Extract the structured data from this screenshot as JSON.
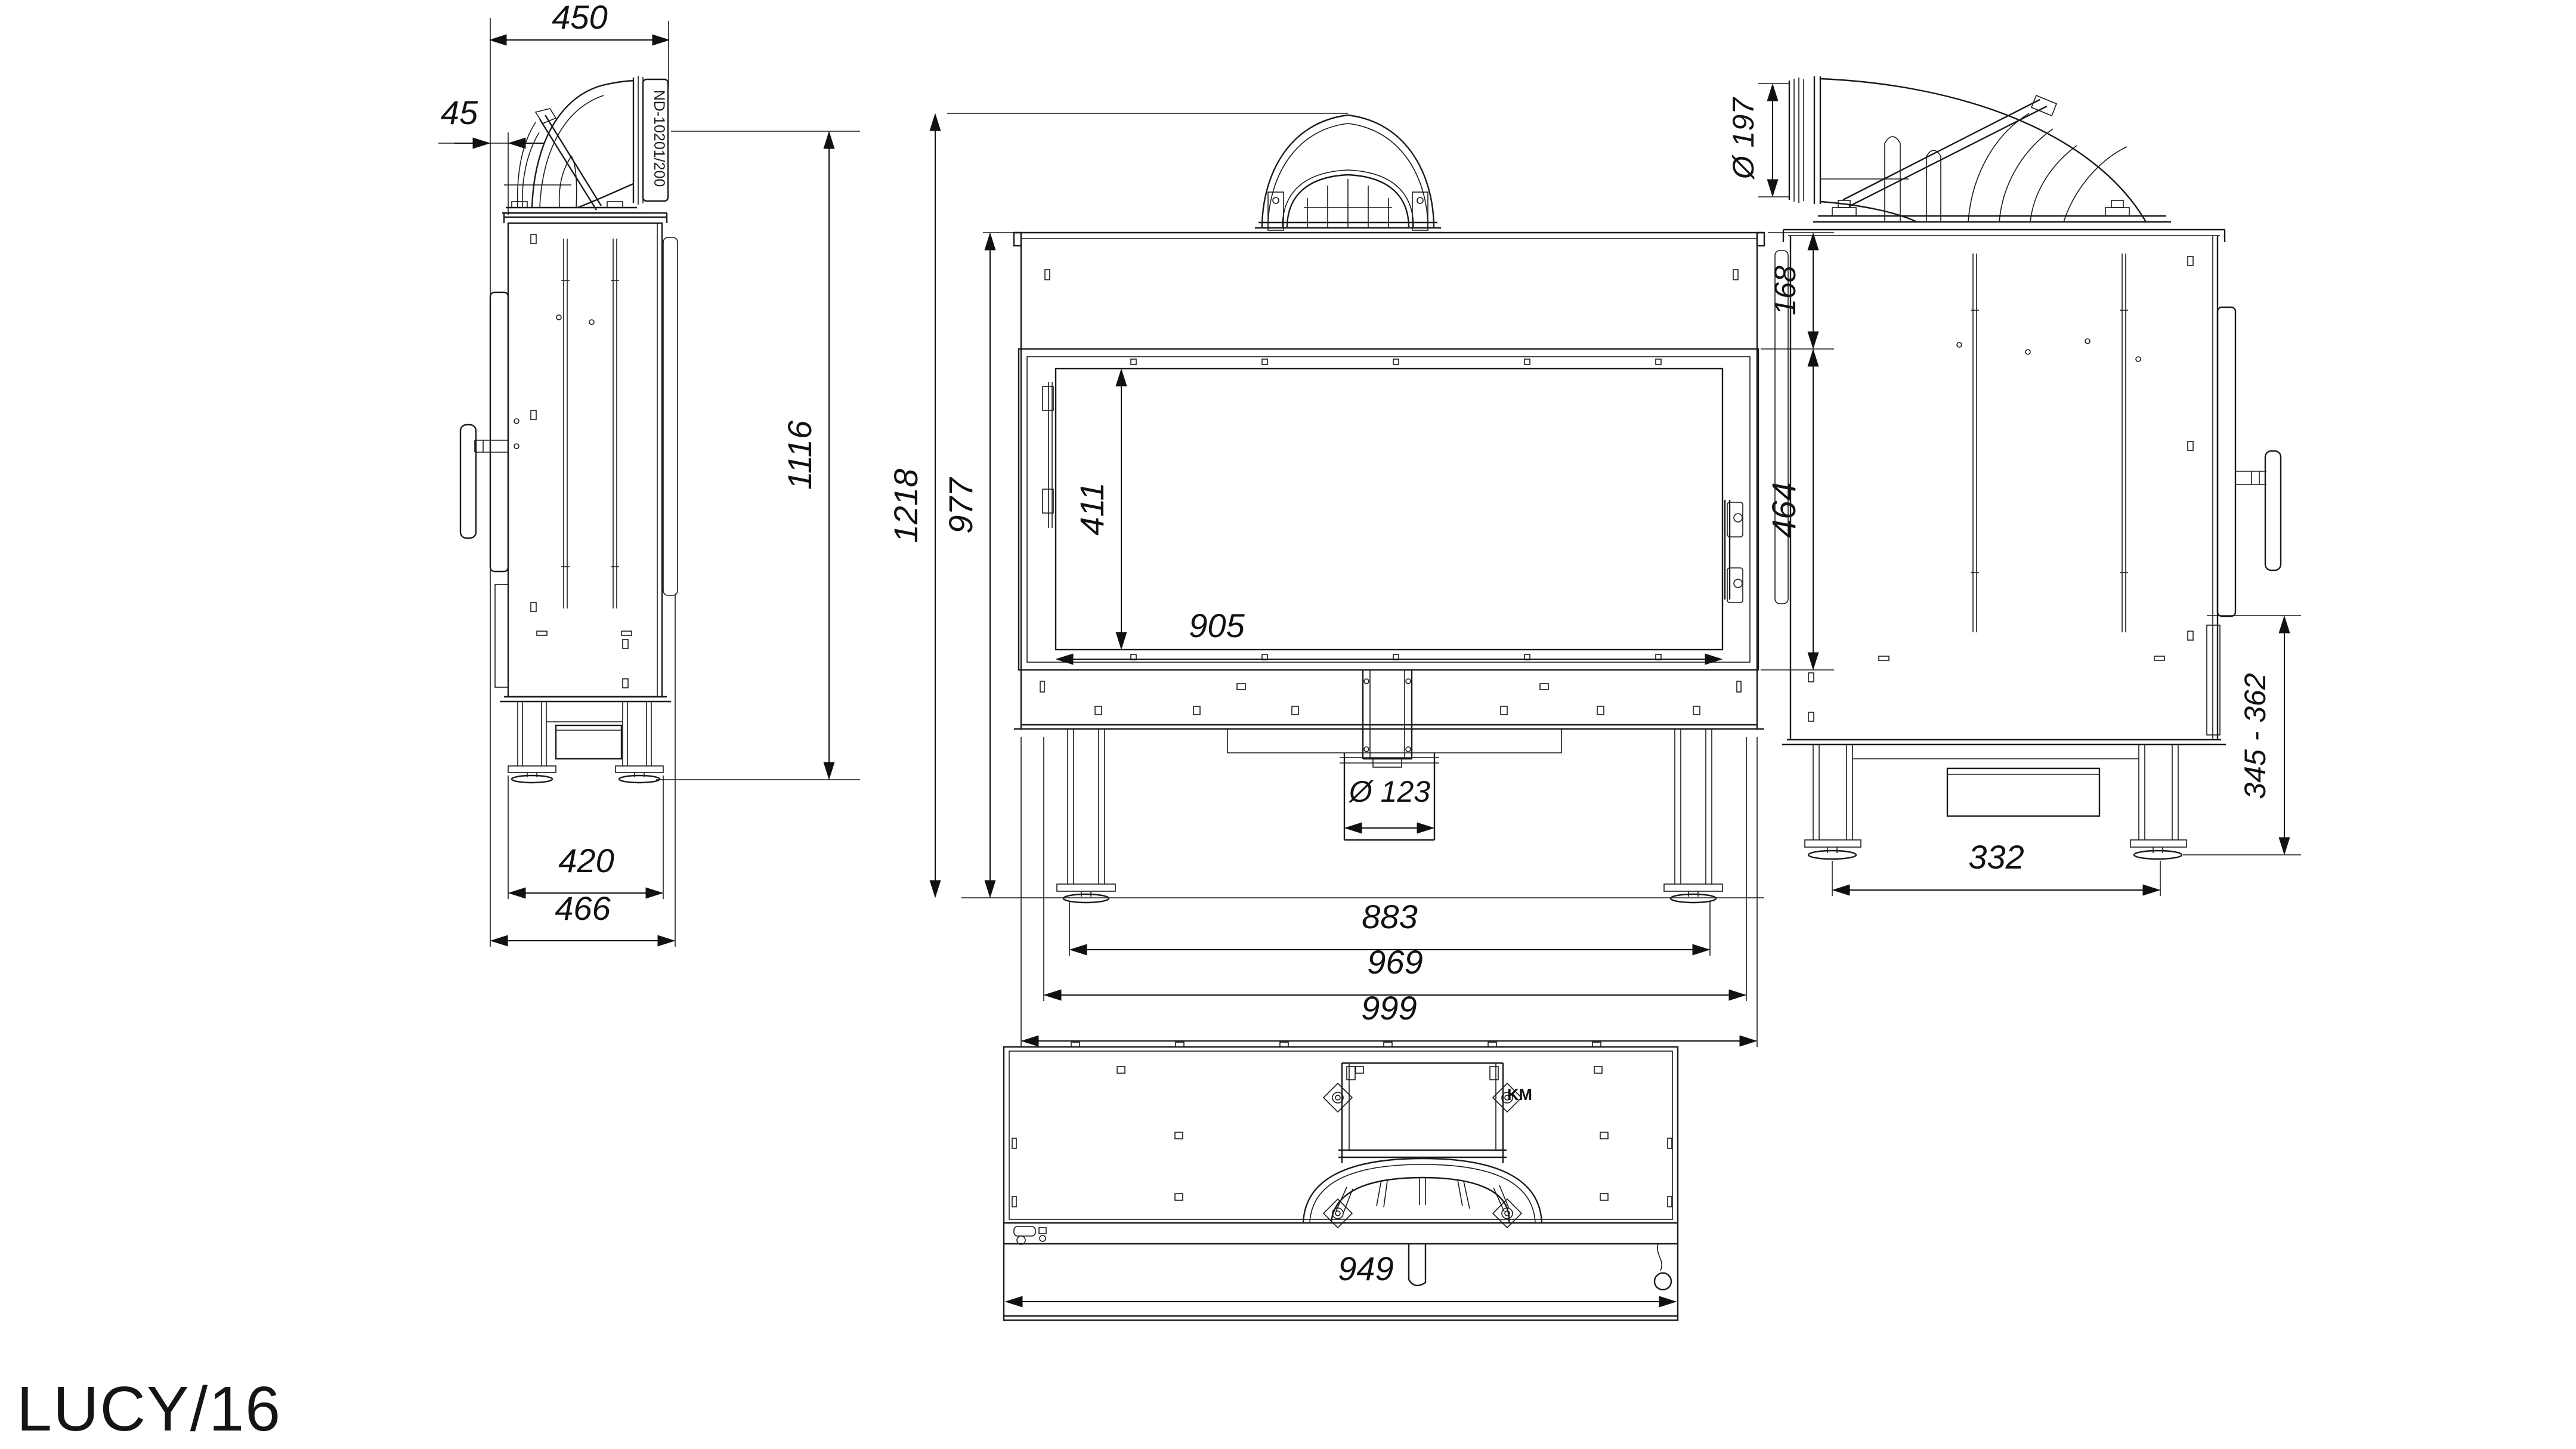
{
  "title": {
    "model_label": "LUCY/16"
  },
  "annotations": {
    "duct_part_label": "ND-10201/200",
    "collar_mark": "KM"
  },
  "views": {
    "side_left": {
      "name": "left side view",
      "dims": {
        "duct_top_width": "450",
        "front_offset": "45",
        "height_to_flue": "1116",
        "feet_spacing": "420",
        "overall_depth": "466"
      }
    },
    "front": {
      "name": "front view",
      "dims": {
        "overall_height": "1218",
        "body_height": "977",
        "top_to_glass": "168",
        "glass_height": "411",
        "glass_width": "905",
        "door_height": "464",
        "air_inlet_diameter": "Ø 123",
        "feet_spacing": "883",
        "front_frame_width": "969",
        "overall_width": "999"
      }
    },
    "side_right": {
      "name": "right side view",
      "dims": {
        "flue_outlet_diameter": "Ø 197",
        "adjustable_base_height": "345 - 362",
        "feet_spacing": "332"
      }
    },
    "top": {
      "name": "top view",
      "dims": {
        "overall_width": "949"
      }
    }
  }
}
